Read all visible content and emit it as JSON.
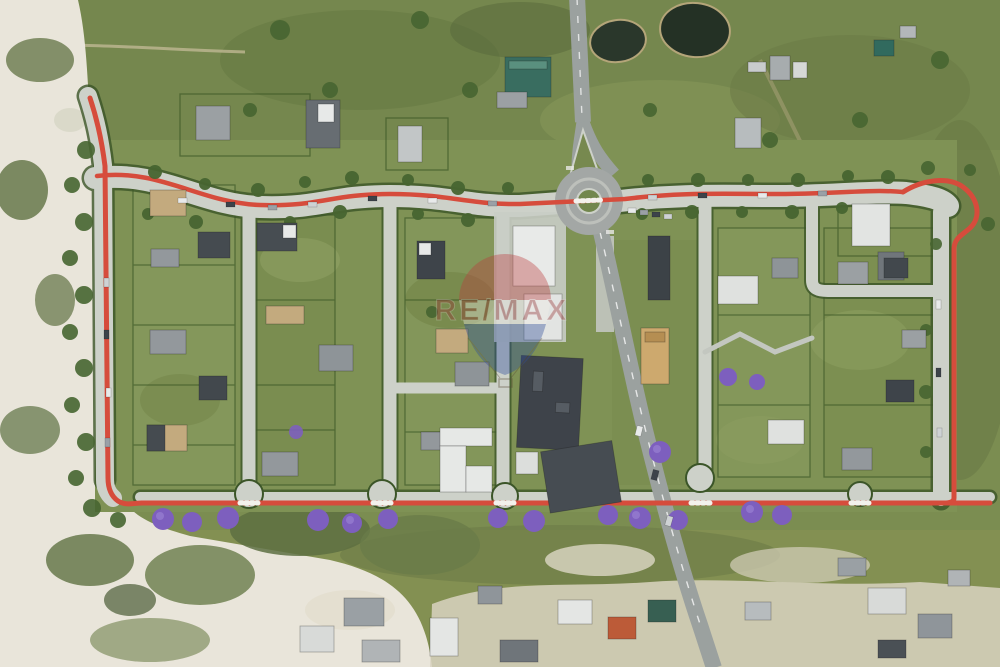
{
  "page": {
    "type": "aerial-drone-photograph",
    "description": "Top-down aerial photo of a master-planned residential estate bounded by a red pedestrian and cycle pathway, sandy dunes to the west, a roundabout with access road to the north, two dark ponds, jacaranda trees along the southern path, large dark-roofed apartment buildings in the centre and an existing village to the south."
  },
  "watermark": {
    "text": "RE/MAX",
    "balloon": {
      "top_color": "#c23c3c",
      "band_color": "#f2efe8",
      "bottom_color": "#2d4e9e"
    },
    "text_color": "#993333",
    "opacity": 0.35
  },
  "palette": {
    "grass": "#7e9252",
    "field_grass": "#74874b",
    "scrub": "#5f7240",
    "sand": "#e9e5d9",
    "street": "#cdd1c9",
    "asphalt": "#9ba19f",
    "red_path": "#dc4b3a",
    "hedge": "#3a5526",
    "pond": "#22301f",
    "jacaranda": "#7e5ec2",
    "roof_dark": "#3e434a",
    "roof_gray": "#93989c",
    "roof_light": "#e8eae8",
    "roof_tan": "#cfa96b",
    "roof_teal": "#376e60",
    "roof_orange": "#c05a35"
  },
  "features": [
    "red perimeter walking path",
    "roundabout",
    "north access road with Y-split median",
    "diagonal road to south-east",
    "two ponds",
    "five cul-de-sac bulbs",
    "sand dunes west",
    "jacaranda trees along south path",
    "single-family housing lots",
    "central apartment buildings",
    "existing village south",
    "RE/MAX balloon watermark"
  ]
}
